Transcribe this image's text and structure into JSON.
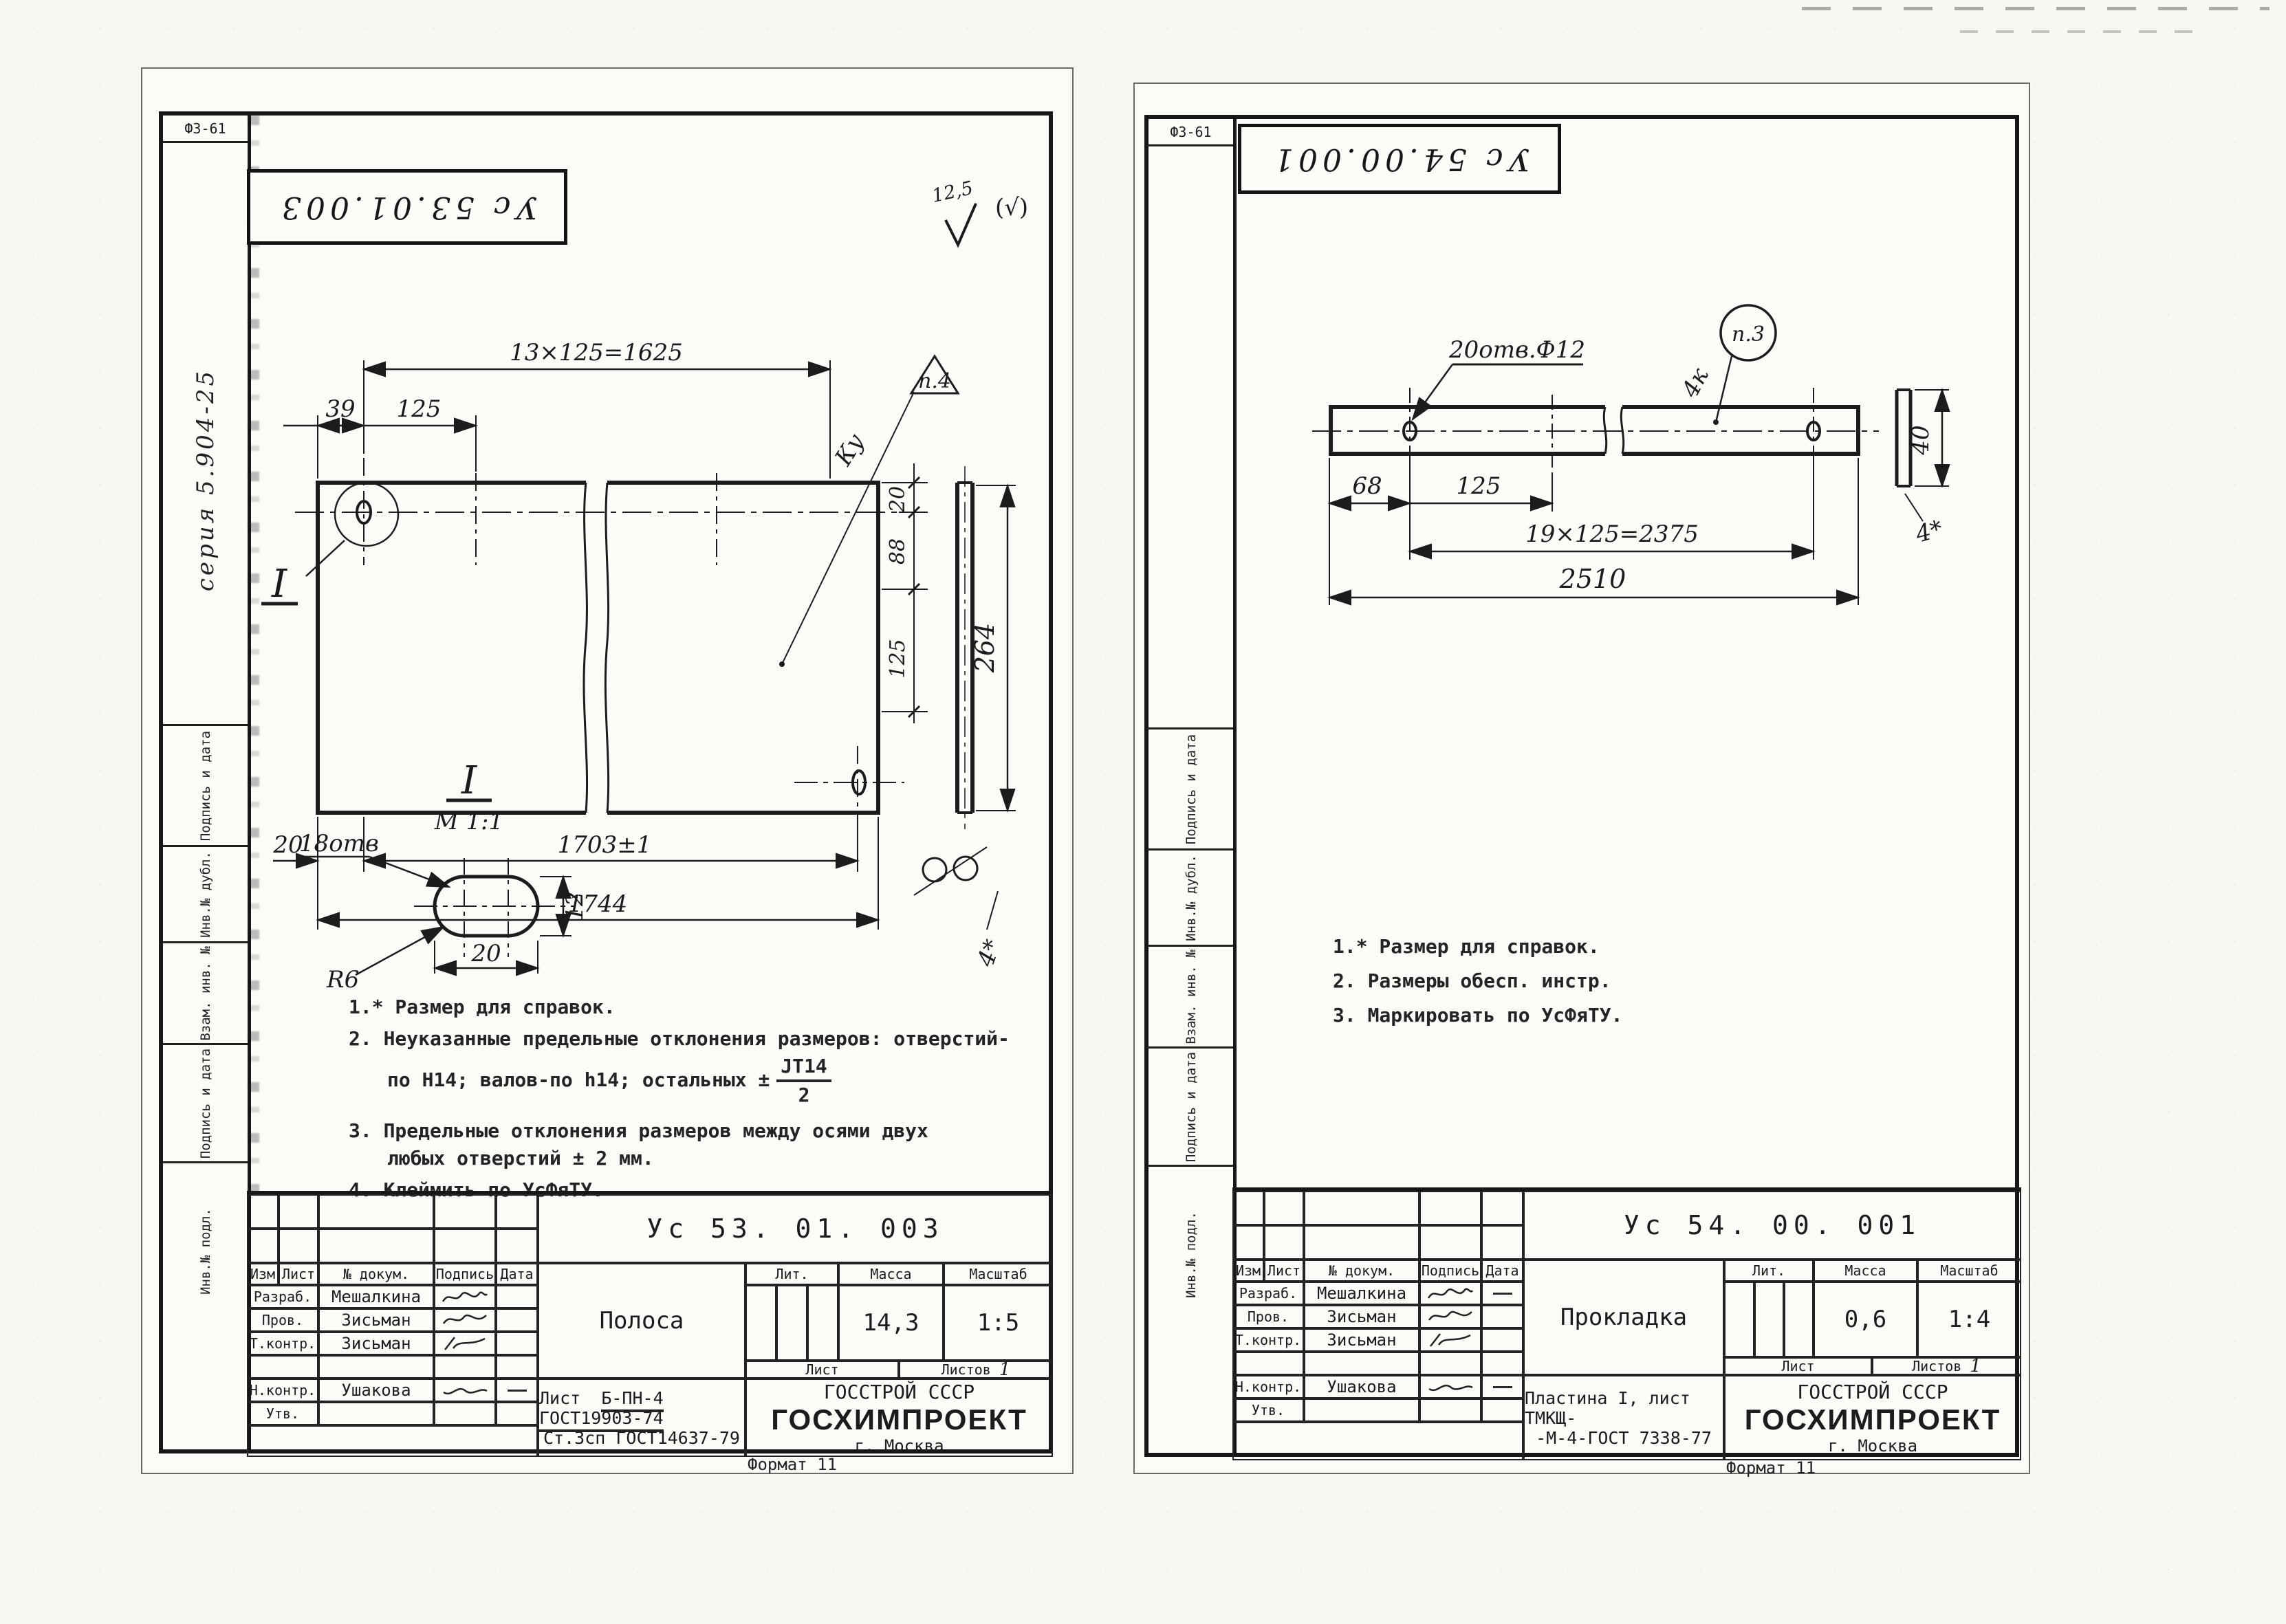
{
  "page": {
    "number": "43",
    "format_note": "Формат 11"
  },
  "margin": {
    "form_code": "Ф3-61",
    "series": "серия 5.904-25",
    "sign_date": "Подпись и дата",
    "inv_dubl": "Инв.№ дубл.",
    "vzam_inv": "Взам. инв. №",
    "inv_podl": "Инв.№ подл."
  },
  "left": {
    "stamp": "Ус 53.01.003",
    "roughness_value": "12,5",
    "roughness_mark": "(√)",
    "drawing": {
      "dim_top": "13×125=1625",
      "dim_39": "39",
      "dim_125": "125",
      "flag": "п.4",
      "ku": "Ку",
      "dim_v20": "20",
      "dim_v88": "88",
      "dim_v125": "125",
      "dim_264": "264",
      "dim_b20": "20",
      "dim_1703": "1703±1",
      "dim_1744": "1744",
      "dim_thickness": "4*",
      "section_mark": "I"
    },
    "detail": {
      "mark": "I",
      "scale": "М 1:1",
      "holes": "18отв",
      "radius": "R6",
      "dim_w": "20",
      "dim_h": "12"
    },
    "notes": {
      "n1": "1.* Размер для справок.",
      "n2a": "2. Неуказанные предельные отклонения размеров: отверстий-",
      "n2b": "по Н14; валов-по h14; остальных ±",
      "n2_num": "JT14",
      "n2_den": "2",
      "n3a": "3. Предельные отклонения размеров между осями двух",
      "n3b": "любых отверстий ± 2 мм.",
      "n4": "4. Клеймить по УсФяТУ."
    },
    "tb": {
      "designation": "Ус 53. 01. 003",
      "col_izm": "Изм",
      "col_list": "Лист",
      "col_doc": "№ докум.",
      "col_sign": "Подпись",
      "col_date": "Дата",
      "r1_role": "Разраб.",
      "r1_name": "Мешалкина",
      "r2_role": "Пров.",
      "r2_name": "Зисьман",
      "r3_role": "Т.контр.",
      "r3_name": "Зисьман",
      "r4_role": "Н.контр.",
      "r4_name": "Ушакова",
      "r5_role": "Утв.",
      "part_name": "Полоса",
      "lit_label": "Лит.",
      "mass_label": "Масса",
      "scale_label": "Масштаб",
      "mass": "14,3",
      "scale": "1:5",
      "list_label": "Лист",
      "listov_label": "Листов",
      "listov_value": "1",
      "material_prefix": "Лист",
      "material1": "Б-ПН-4 ГОСТ19903-74",
      "material2": "Ст.3сп ГОСТ14637-79",
      "org1": "ГОССТРОЙ СССР",
      "org2": "ГОСХИМПРОЕКТ",
      "org3": "г. Москва"
    }
  },
  "right": {
    "stamp": "Ус 54.00.001",
    "drawing": {
      "holes_label": "20отв.Ф12",
      "flag": "п.3",
      "k4": "4к",
      "dim_68": "68",
      "dim_125": "125",
      "dim_2375": "19×125=2375",
      "dim_2510": "2510",
      "dim_40": "40",
      "dim_thickness": "4*"
    },
    "notes": {
      "n1": "1.* Размер для справок.",
      "n2": "2. Размеры обесп. инстр.",
      "n3": "3. Маркировать по УсФяТУ."
    },
    "tb": {
      "designation": "Ус 54. 00. 001",
      "col_izm": "Изм",
      "col_list": "Лист",
      "col_doc": "№ докум.",
      "col_sign": "Подпись",
      "col_date": "Дата",
      "r1_role": "Разраб.",
      "r1_name": "Мешалкина",
      "r2_role": "Пров.",
      "r2_name": "Зисьман",
      "r3_role": "Т.контр.",
      "r3_name": "Зисьман",
      "r4_role": "Н.контр.",
      "r4_name": "Ушакова",
      "r5_role": "Утв.",
      "part_name": "Прокладка",
      "lit_label": "Лит.",
      "mass_label": "Масса",
      "scale_label": "Масштаб",
      "mass": "0,6",
      "scale": "1:4",
      "list_label": "Лист",
      "listov_label": "Листов",
      "listov_value": "1",
      "material1": "Пластина I, лист ТМКЩ-",
      "material2": "-М-4-ГОСТ 7338-77",
      "org1": "ГОССТРОЙ СССР",
      "org2": "ГОСХИМПРОЕКТ",
      "org3": "г. Москва"
    }
  }
}
